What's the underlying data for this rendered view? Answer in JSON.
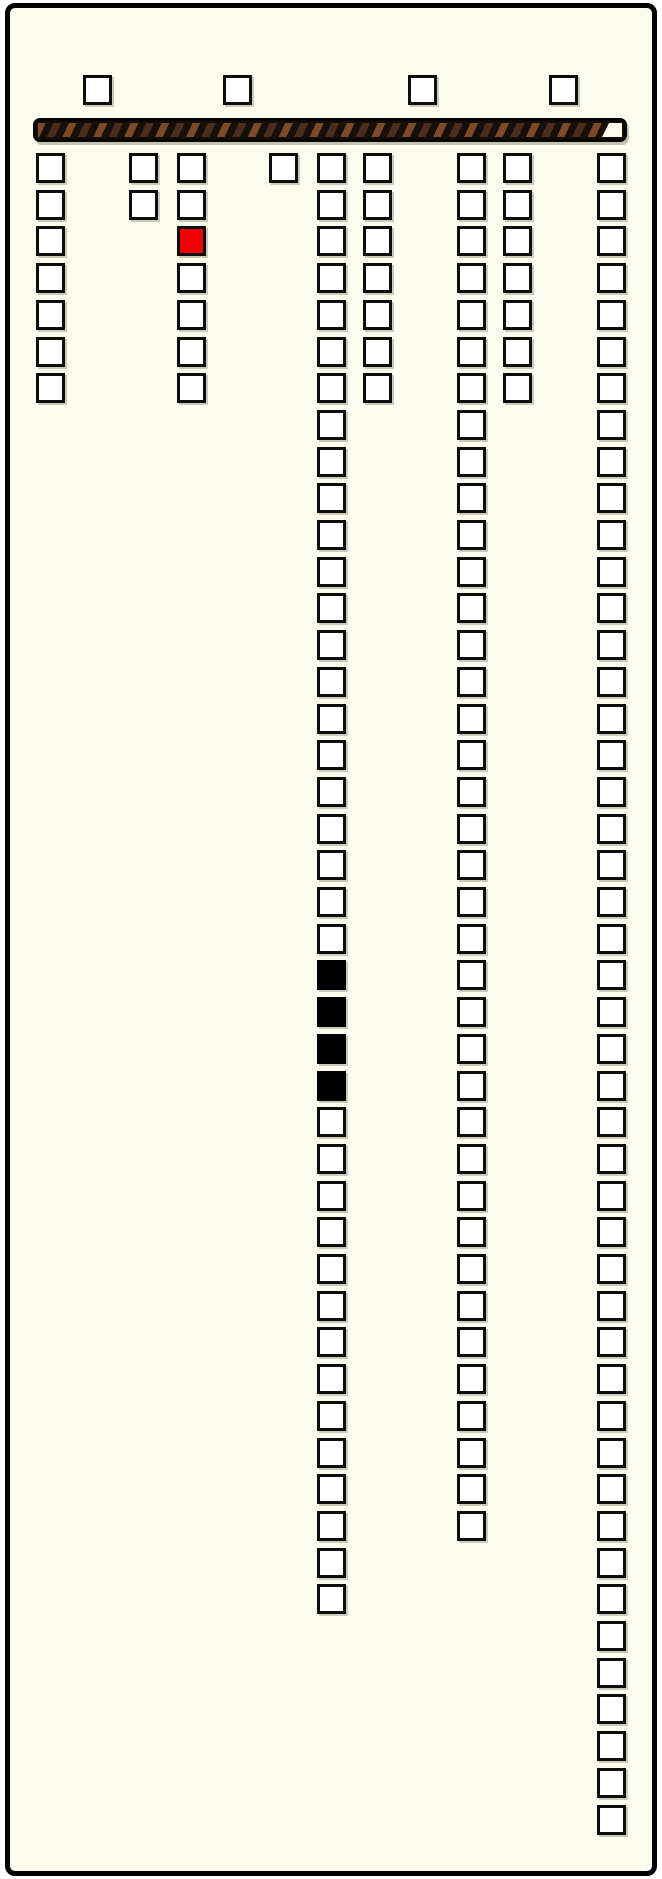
{
  "canvas": {
    "width": 662,
    "height": 1879,
    "page_bg": "#ffffff"
  },
  "colors": {
    "frame_border": "#000000",
    "panel_bg": "#fdfdef",
    "cell_border": "#0d0d0d",
    "cell_fill": "#ffffff",
    "cell_red": "#ee0404",
    "cell_black": "#000000",
    "bar_base": "#140d07",
    "bar_stripe_light": "#7b4a29",
    "bar_stripe_dark": "#4b2d1d",
    "bar_unfilled": "#fdfdef"
  },
  "frame": {
    "x": 5,
    "y": 3,
    "width": 652,
    "height": 1873,
    "border_width": 5,
    "corner_radius": 10
  },
  "top_row": {
    "y": 75,
    "cell_width": 29,
    "cell_height": 30,
    "xs": [
      83,
      223,
      408,
      549
    ]
  },
  "progress_bar": {
    "x": 33,
    "y": 118,
    "width": 594,
    "height": 24,
    "fill_percent": 96.5,
    "notch_width": 20,
    "stripe_angle_deg": 115
  },
  "grid": {
    "first_row_y": 153,
    "row_pitch": 36.7,
    "cell_width": 29,
    "cell_height": 30,
    "columns": [
      {
        "id": 1,
        "x": 36,
        "count": 7,
        "red_rows": [],
        "black_rows": []
      },
      {
        "id": 2,
        "x": 129,
        "count": 2,
        "red_rows": [],
        "black_rows": []
      },
      {
        "id": 3,
        "x": 177,
        "count": 7,
        "red_rows": [
          3
        ],
        "black_rows": []
      },
      {
        "id": 4,
        "x": 269,
        "count": 1,
        "red_rows": [],
        "black_rows": []
      },
      {
        "id": 5,
        "x": 317,
        "count": 40,
        "red_rows": [],
        "black_rows": [
          23,
          24,
          25,
          26
        ]
      },
      {
        "id": 6,
        "x": 363,
        "count": 7,
        "red_rows": [],
        "black_rows": []
      },
      {
        "id": 7,
        "x": 457,
        "count": 38,
        "red_rows": [],
        "black_rows": []
      },
      {
        "id": 8,
        "x": 503,
        "count": 7,
        "red_rows": [],
        "black_rows": []
      },
      {
        "id": 9,
        "x": 597,
        "count": 46,
        "red_rows": [],
        "black_rows": []
      }
    ]
  }
}
